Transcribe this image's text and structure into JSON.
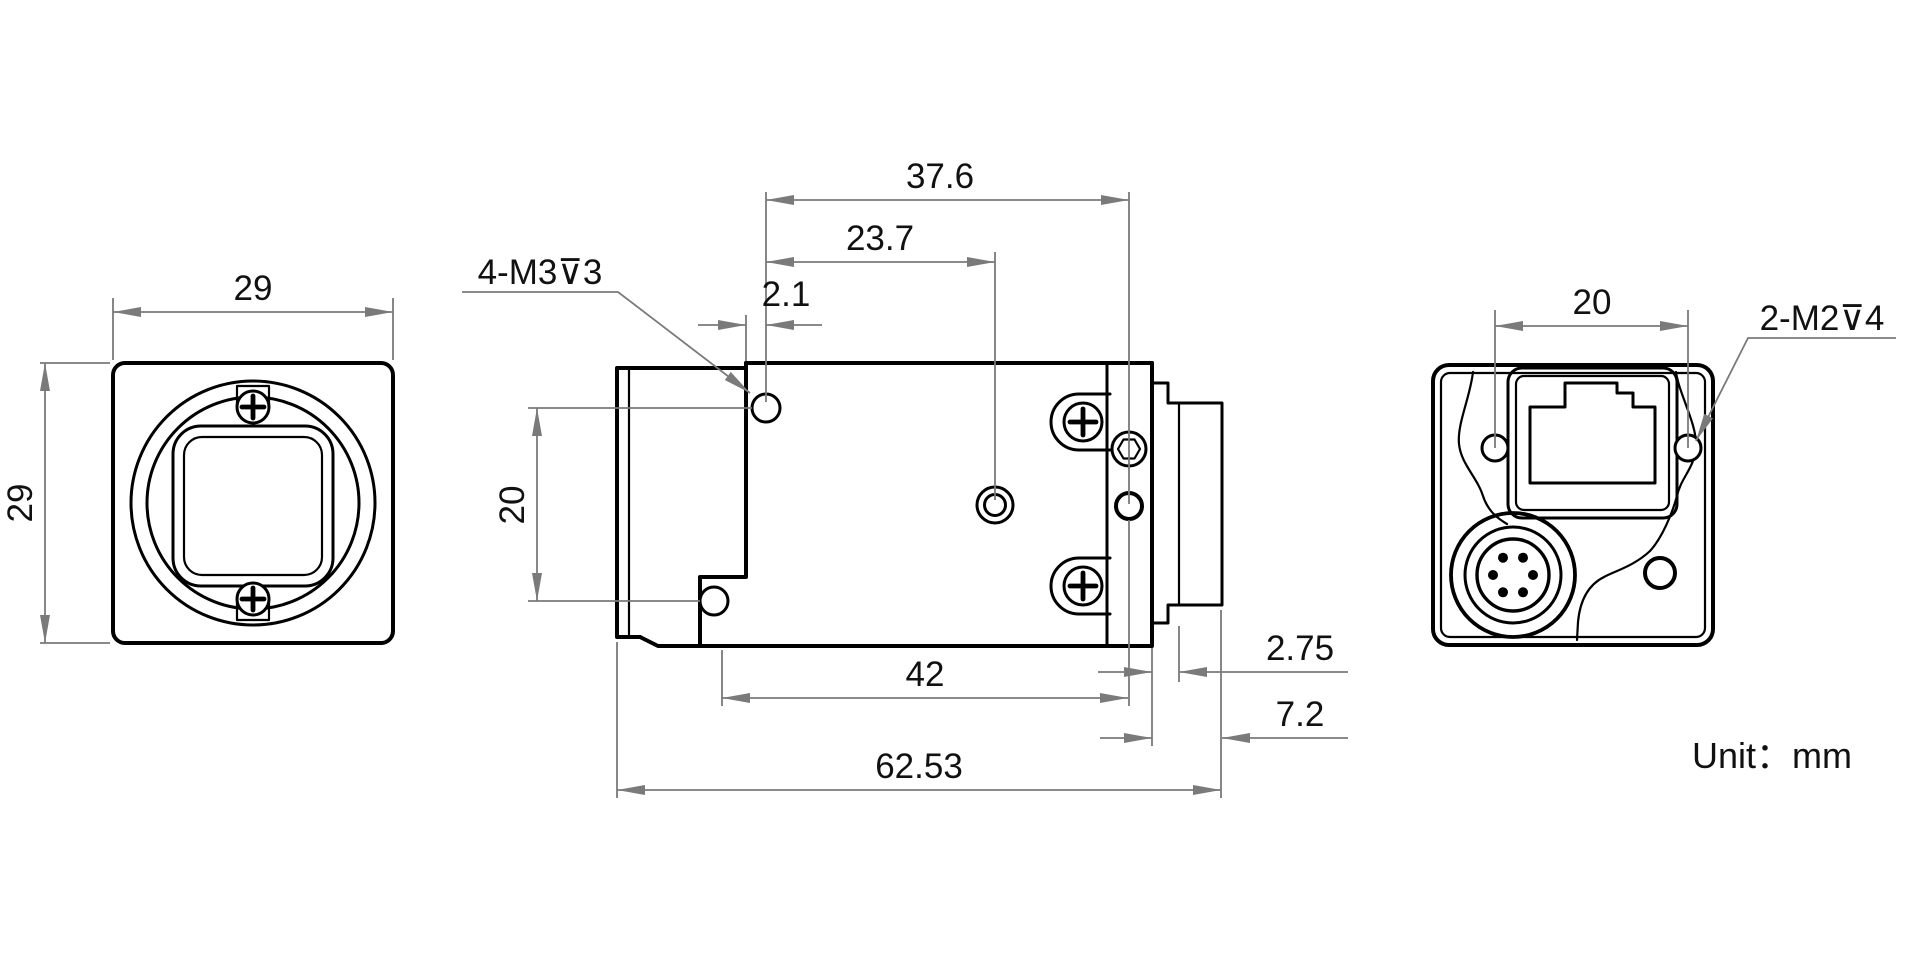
{
  "unit": {
    "label": "Unit：mm"
  },
  "front_view": {
    "width_dim": "29",
    "height_dim": "29"
  },
  "side_view": {
    "thread_note": "4-M3⊽3",
    "dim_37_6": "37.6",
    "dim_23_7": "23.7",
    "dim_2_1": "2.1",
    "dim_20": "20",
    "dim_42": "42",
    "dim_62_53": "62.53",
    "dim_2_75": "2.75",
    "dim_7_2": "7.2"
  },
  "back_view": {
    "dim_20": "20",
    "thread_note": "2-M2⊽4"
  },
  "colors": {
    "line": "#000000",
    "dim_line": "#7a7a7a",
    "text": "#111111",
    "background": "#ffffff"
  }
}
